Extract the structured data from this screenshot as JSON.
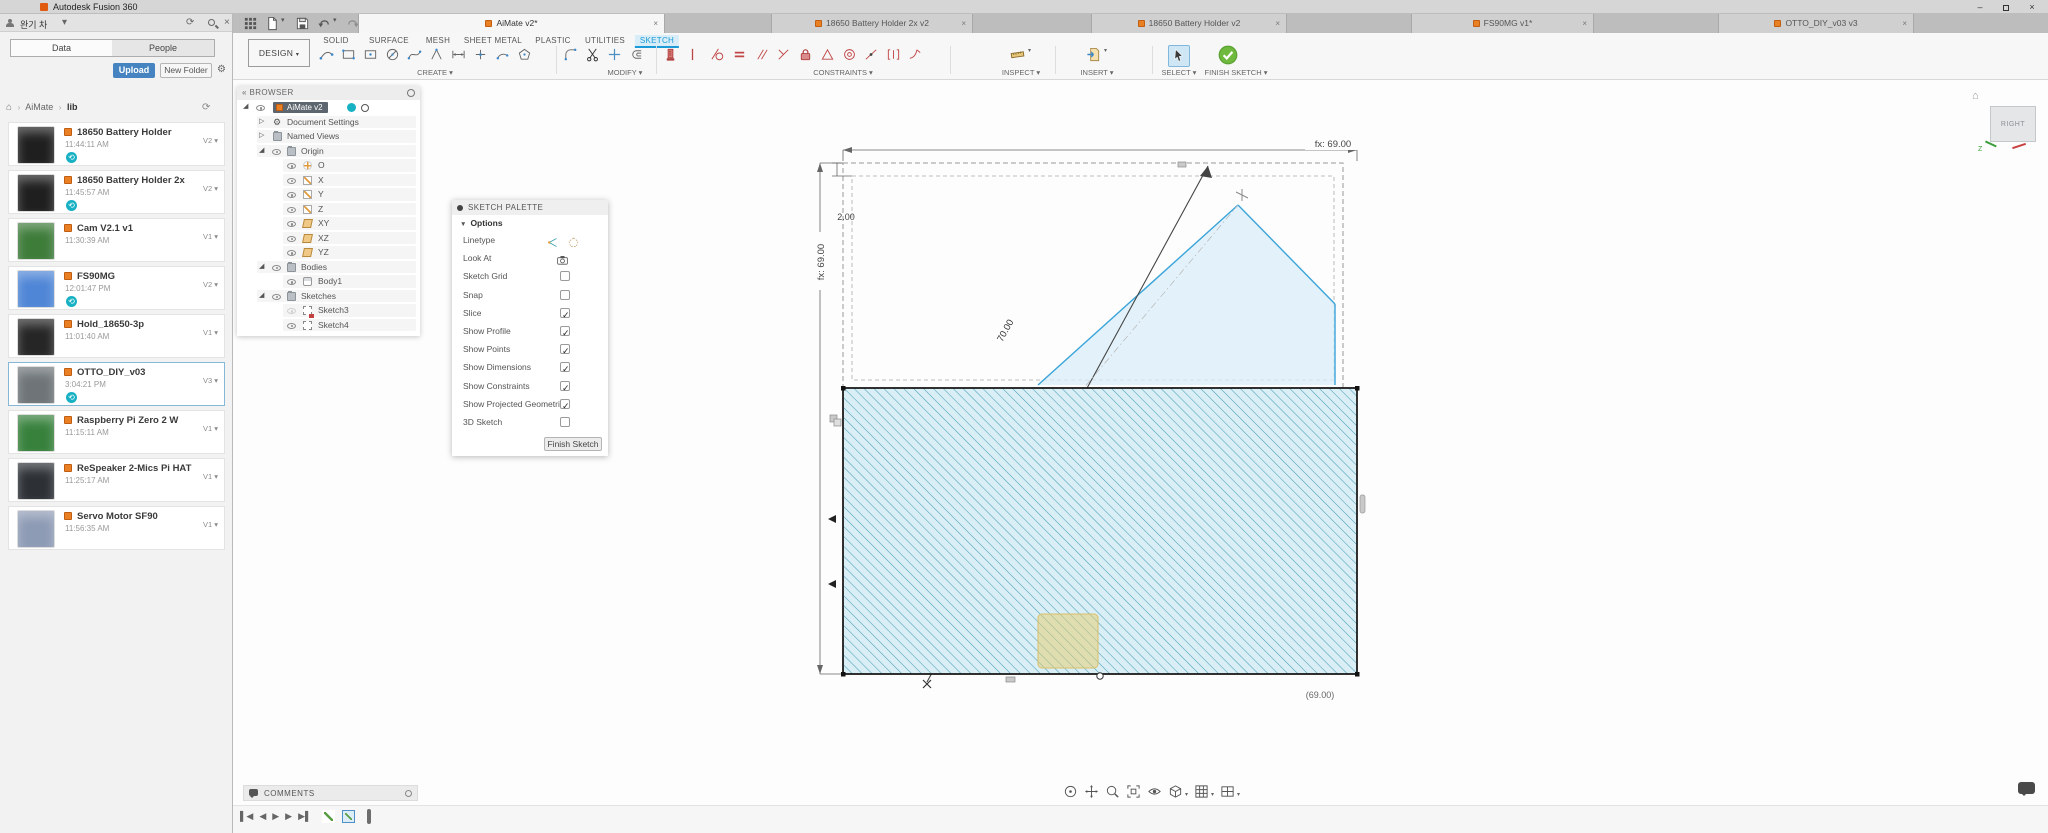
{
  "window": {
    "title": "Autodesk Fusion 360"
  },
  "icons": {
    "chevron_down": "▾",
    "close": "×",
    "refresh": "⟳",
    "gear": "⚙",
    "home": "⌂",
    "sep": "›",
    "plus": "+",
    "menu": "≡",
    "minimize": "–",
    "collapse": "«",
    "expanded": "◢",
    "collapsed": "▷",
    "badge": "⟲"
  },
  "data_panel": {
    "user_name": "완기 차",
    "tabs": [
      {
        "label": "Data"
      },
      {
        "label": "People"
      }
    ],
    "upload_button": "Upload",
    "new_folder_button": "New Folder",
    "breadcrumb": {
      "root": "AiMate",
      "current": "lib"
    },
    "items": [
      {
        "name": "18650 Battery Holder",
        "time": "11:44:11 AM",
        "version": "V2 ▾",
        "badge": true,
        "selected": false,
        "thumb": "#1f1f1f"
      },
      {
        "name": "18650 Battery Holder 2x",
        "time": "11:45:57 AM",
        "version": "V2 ▾",
        "badge": true,
        "selected": false,
        "thumb": "#1f1f1f"
      },
      {
        "name": "Cam V2.1 v1",
        "time": "11:30:39 AM",
        "version": "V1 ▾",
        "badge": false,
        "selected": false,
        "thumb": "#3e7c3a"
      },
      {
        "name": "FS90MG",
        "time": "12:01:47 PM",
        "version": "V2 ▾",
        "badge": true,
        "selected": false,
        "thumb": "#4f86d6"
      },
      {
        "name": "Hold_18650-3p",
        "time": "11:01:40 AM",
        "version": "V1 ▾",
        "badge": false,
        "selected": false,
        "thumb": "#262626"
      },
      {
        "name": "OTTO_DIY_v03",
        "time": "3:04:21 PM",
        "version": "V3 ▾",
        "badge": true,
        "selected": true,
        "thumb": "#6e7478"
      },
      {
        "name": "Raspberry Pi Zero 2 W",
        "time": "11:15:11 AM",
        "version": "V1 ▾",
        "badge": false,
        "selected": false,
        "thumb": "#37813c"
      },
      {
        "name": "ReSpeaker 2-Mics Pi HAT",
        "time": "11:25:17 AM",
        "version": "V1 ▾",
        "badge": false,
        "selected": false,
        "thumb": "#2d3136"
      },
      {
        "name": "Servo Motor SF90",
        "time": "11:56:35 AM",
        "version": "V1 ▾",
        "badge": false,
        "selected": false,
        "thumb": "#8e9bb5"
      }
    ]
  },
  "document_tabs": {
    "tabs": [
      {
        "label": "AiMate v2*",
        "active": true
      },
      {
        "label": "18650 Battery Holder 2x v2",
        "active": false
      },
      {
        "label": "18650 Battery Holder v2",
        "active": false
      },
      {
        "label": "FS90MG v1*",
        "active": false
      },
      {
        "label": "OTTO_DIY_v03 v3",
        "active": false
      }
    ]
  },
  "toolbar": {
    "design_button": "DESIGN",
    "tabs": [
      {
        "label": "SOLID",
        "active": false
      },
      {
        "label": "SURFACE",
        "active": false
      },
      {
        "label": "MESH",
        "active": false
      },
      {
        "label": "SHEET METAL",
        "active": false
      },
      {
        "label": "PLASTIC",
        "active": false
      },
      {
        "label": "UTILITIES",
        "active": false
      },
      {
        "label": "SKETCH",
        "active": true
      }
    ],
    "groups": {
      "create": "CREATE ▾",
      "modify": "MODIFY ▾",
      "constraints": "CONSTRAINTS ▾",
      "inspect": "INSPECT ▾",
      "insert": "INSERT ▾",
      "select": "SELECT ▾",
      "finish": "FINISH SKETCH ▾"
    }
  },
  "browser": {
    "title": "BROWSER",
    "root": "AiMate v2",
    "nodes": [
      "Document Settings",
      "Named Views",
      "Origin"
    ],
    "origin_children": [
      "O",
      "X",
      "Y",
      "Z",
      "XY",
      "XZ",
      "YZ"
    ],
    "bodies_label": "Bodies",
    "body": "Body1",
    "sketches_label": "Sketches",
    "sketches": [
      "Sketch3",
      "Sketch4"
    ]
  },
  "sketch_palette": {
    "title": "SKETCH PALETTE",
    "section": "Options",
    "rows": [
      {
        "label": "Linetype",
        "is_checkbox": false,
        "checked": false
      },
      {
        "label": "Look At",
        "is_checkbox": false,
        "checked": false
      },
      {
        "label": "Sketch Grid",
        "is_checkbox": true,
        "checked": false
      },
      {
        "label": "Snap",
        "is_checkbox": true,
        "checked": false
      },
      {
        "label": "Slice",
        "is_checkbox": true,
        "checked": true
      },
      {
        "label": "Show Profile",
        "is_checkbox": true,
        "checked": true
      },
      {
        "label": "Show Points",
        "is_checkbox": true,
        "checked": true
      },
      {
        "label": "Show Dimensions",
        "is_checkbox": true,
        "checked": true
      },
      {
        "label": "Show Constraints",
        "is_checkbox": true,
        "checked": true
      },
      {
        "label": "Show Projected Geometries",
        "is_checkbox": true,
        "checked": true
      },
      {
        "label": "3D Sketch",
        "is_checkbox": true,
        "checked": false
      }
    ],
    "finish_button": "Finish Sketch"
  },
  "canvas": {
    "dim_top": "fx: 69.00",
    "dim_left": "fx: 69.00",
    "dim_gap": "2.00",
    "dim_diag": "70.00",
    "dim_bottom": "(69.00)",
    "view_cube_face": "RIGHT",
    "axis_z": "Z"
  },
  "comments": {
    "label": "COMMENTS"
  },
  "timeline": {
    "buttons": [
      {
        "g": "▌◀"
      },
      {
        "g": "◀"
      },
      {
        "g": "▶"
      },
      {
        "g": "▶"
      },
      {
        "g": "▶▌"
      }
    ]
  },
  "colors": {
    "accent_blue": "#1a9bd7",
    "constraint_red": "#c04545",
    "hatch_teal": "#4aa0b5",
    "hatch_bg": "#daeef6",
    "select_green": "#6fb93f",
    "badge_teal": "#17b1c4",
    "upload_blue": "#4584c0"
  }
}
